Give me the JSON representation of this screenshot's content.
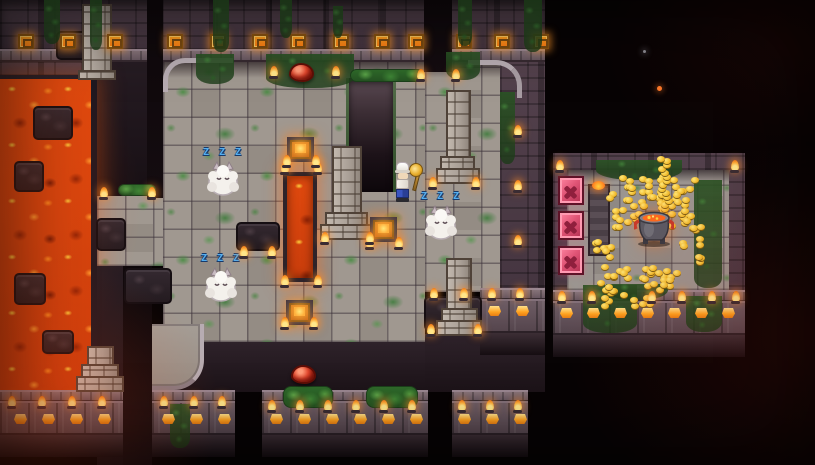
{
  "scene": {
    "name": "volcano-dungeon-map",
    "description": "Top-down pixel-art volcano dungeon: lava pools, mossy stone plaza, sleeping monsters, and a treasure room full of gold with a lava pot",
    "width": 815,
    "height": 465
  },
  "text": {
    "sleep_bubble": "Z Z Z"
  },
  "palette": {
    "void": "#0a0506",
    "wall": "#4e3d47",
    "wall_dark": "#382b33",
    "ledge": "#7d6b73",
    "floor": "#a09890",
    "floor_alt": "#948c84",
    "moss": "#4e8f4a",
    "lava_bright": "#ff8c1f",
    "lava": "#e0490e",
    "lava_dark": "#8f2205",
    "gold": "#f5c030",
    "ornament_glow": "#ff9a2e",
    "zzz_blue": "#53aef0",
    "slime_red": "#d8301f",
    "block_pink": "#e85878",
    "monster_white": "#f4f1ec"
  },
  "entities": {
    "monsters": [
      {
        "id": "sleeping-monster-1",
        "x": 206,
        "y": 160
      },
      {
        "id": "sleeping-monster-2",
        "x": 204,
        "y": 266
      },
      {
        "id": "sleeping-monster-3",
        "x": 424,
        "y": 204
      }
    ],
    "slimes": [
      {
        "id": "red-slime-1",
        "x": 289,
        "y": 63
      },
      {
        "id": "red-slime-2",
        "x": 291,
        "y": 365
      }
    ],
    "player": {
      "x": 396,
      "y": 160,
      "held_item": "golden-pan"
    },
    "glow_tiles": [
      {
        "x": 287,
        "y": 137
      },
      {
        "x": 370,
        "y": 217
      },
      {
        "x": 286,
        "y": 300
      }
    ],
    "treasure_room": {
      "pot": {
        "x": 634,
        "y": 204
      },
      "coin_clusters": [
        {
          "x": 606,
          "y": 174,
          "w": 94,
          "h": 56,
          "n": 66
        },
        {
          "x": 596,
          "y": 264,
          "w": 86,
          "h": 46,
          "n": 42
        },
        {
          "x": 655,
          "y": 156,
          "w": 20,
          "h": 64,
          "n": 16
        },
        {
          "x": 590,
          "y": 234,
          "w": 28,
          "h": 26,
          "n": 9
        },
        {
          "x": 678,
          "y": 224,
          "w": 28,
          "h": 42,
          "n": 11
        }
      ],
      "x_blocks": [
        {
          "x": 558,
          "y": 176
        },
        {
          "x": 558,
          "y": 211
        },
        {
          "x": 558,
          "y": 246
        }
      ],
      "pillar": {
        "x": 588,
        "y": 184,
        "w": 22,
        "h": 72
      }
    }
  },
  "decor": {
    "ornaments": {
      "y": 34,
      "xs": [
        18,
        60,
        107,
        167,
        210,
        252,
        290,
        333,
        374,
        408,
        456,
        494,
        533
      ]
    },
    "torches": [
      [
        270,
        66
      ],
      [
        332,
        66
      ],
      [
        417,
        69
      ],
      [
        452,
        69
      ],
      [
        281,
        162
      ],
      [
        314,
        162
      ],
      [
        281,
        275
      ],
      [
        314,
        275
      ],
      [
        283,
        155
      ],
      [
        312,
        155
      ],
      [
        366,
        237
      ],
      [
        395,
        237
      ],
      [
        281,
        317
      ],
      [
        310,
        317
      ],
      [
        240,
        246
      ],
      [
        268,
        246
      ],
      [
        321,
        232
      ],
      [
        366,
        232
      ],
      [
        429,
        177
      ],
      [
        472,
        177
      ],
      [
        427,
        324
      ],
      [
        474,
        324
      ],
      [
        100,
        187
      ],
      [
        148,
        187
      ],
      [
        8,
        396
      ],
      [
        38,
        396
      ],
      [
        68,
        396
      ],
      [
        98,
        396
      ],
      [
        160,
        396
      ],
      [
        190,
        396
      ],
      [
        218,
        396
      ],
      [
        268,
        400
      ],
      [
        296,
        400
      ],
      [
        324,
        400
      ],
      [
        352,
        400
      ],
      [
        380,
        400
      ],
      [
        408,
        400
      ],
      [
        458,
        400
      ],
      [
        486,
        400
      ],
      [
        514,
        400
      ],
      [
        430,
        288
      ],
      [
        460,
        288
      ],
      [
        488,
        288
      ],
      [
        516,
        288
      ],
      [
        558,
        291
      ],
      [
        588,
        291
      ],
      [
        648,
        291
      ],
      [
        678,
        291
      ],
      [
        708,
        291
      ],
      [
        732,
        291
      ],
      [
        556,
        160
      ],
      [
        731,
        160
      ],
      [
        514,
        125
      ],
      [
        514,
        180
      ],
      [
        514,
        235
      ]
    ],
    "lamps": [
      [
        14,
        414
      ],
      [
        42,
        414
      ],
      [
        70,
        414
      ],
      [
        98,
        414
      ],
      [
        162,
        414
      ],
      [
        190,
        414
      ],
      [
        218,
        414
      ],
      [
        270,
        414
      ],
      [
        298,
        414
      ],
      [
        326,
        414
      ],
      [
        354,
        414
      ],
      [
        382,
        414
      ],
      [
        410,
        414
      ],
      [
        458,
        414
      ],
      [
        486,
        414
      ],
      [
        514,
        414
      ],
      [
        488,
        306
      ],
      [
        516,
        306
      ],
      [
        560,
        308
      ],
      [
        587,
        308
      ],
      [
        614,
        308
      ],
      [
        641,
        308
      ],
      [
        668,
        308
      ],
      [
        695,
        308
      ],
      [
        722,
        308
      ]
    ],
    "vines": [
      [
        44,
        0,
        16,
        44
      ],
      [
        90,
        0,
        12,
        50
      ],
      [
        213,
        0,
        16,
        52
      ],
      [
        280,
        0,
        12,
        38
      ],
      [
        333,
        6,
        10,
        32
      ],
      [
        458,
        0,
        14,
        46
      ],
      [
        524,
        0,
        18,
        52
      ],
      [
        196,
        54,
        38,
        30
      ],
      [
        266,
        54,
        88,
        34
      ],
      [
        446,
        52,
        34,
        28
      ],
      [
        500,
        92,
        15,
        72
      ],
      [
        170,
        404,
        20,
        44
      ],
      [
        583,
        285,
        54,
        48
      ],
      [
        686,
        296,
        36,
        36
      ],
      [
        596,
        160,
        86,
        20
      ],
      [
        694,
        180,
        28,
        108
      ],
      [
        606,
        284,
        62,
        16
      ]
    ],
    "hedges": [
      [
        350,
        69,
        74,
        13
      ],
      [
        118,
        184,
        38,
        12
      ],
      [
        283,
        386,
        50,
        22
      ],
      [
        366,
        386,
        52,
        22
      ]
    ],
    "rocks": [
      [
        33,
        106,
        40,
        34
      ],
      [
        14,
        161,
        30,
        31
      ],
      [
        14,
        273,
        32,
        32
      ],
      [
        42,
        330,
        32,
        24
      ],
      [
        96,
        218,
        30,
        33
      ],
      [
        124,
        268,
        48,
        36
      ],
      [
        236,
        222,
        44,
        29
      ],
      [
        56,
        31,
        38,
        29
      ],
      [
        424,
        296,
        58,
        35
      ]
    ],
    "monuments": [
      {
        "x": 320,
        "y": 146,
        "w": 54,
        "h": 94,
        "kind": "ziggurat"
      },
      {
        "x": 436,
        "y": 90,
        "w": 44,
        "h": 94,
        "kind": "ziggurat"
      },
      {
        "x": 436,
        "y": 258,
        "w": 46,
        "h": 78,
        "kind": "ziggurat"
      },
      {
        "x": 76,
        "y": 346,
        "w": 48,
        "h": 46,
        "kind": "ziggurat"
      },
      {
        "x": 82,
        "y": 4,
        "w": 30,
        "h": 76,
        "kind": "column"
      }
    ],
    "embers": [
      [
        657,
        86,
        5,
        "#ff7a2a"
      ],
      [
        643,
        50,
        3,
        "#8e8e96"
      ]
    ]
  }
}
